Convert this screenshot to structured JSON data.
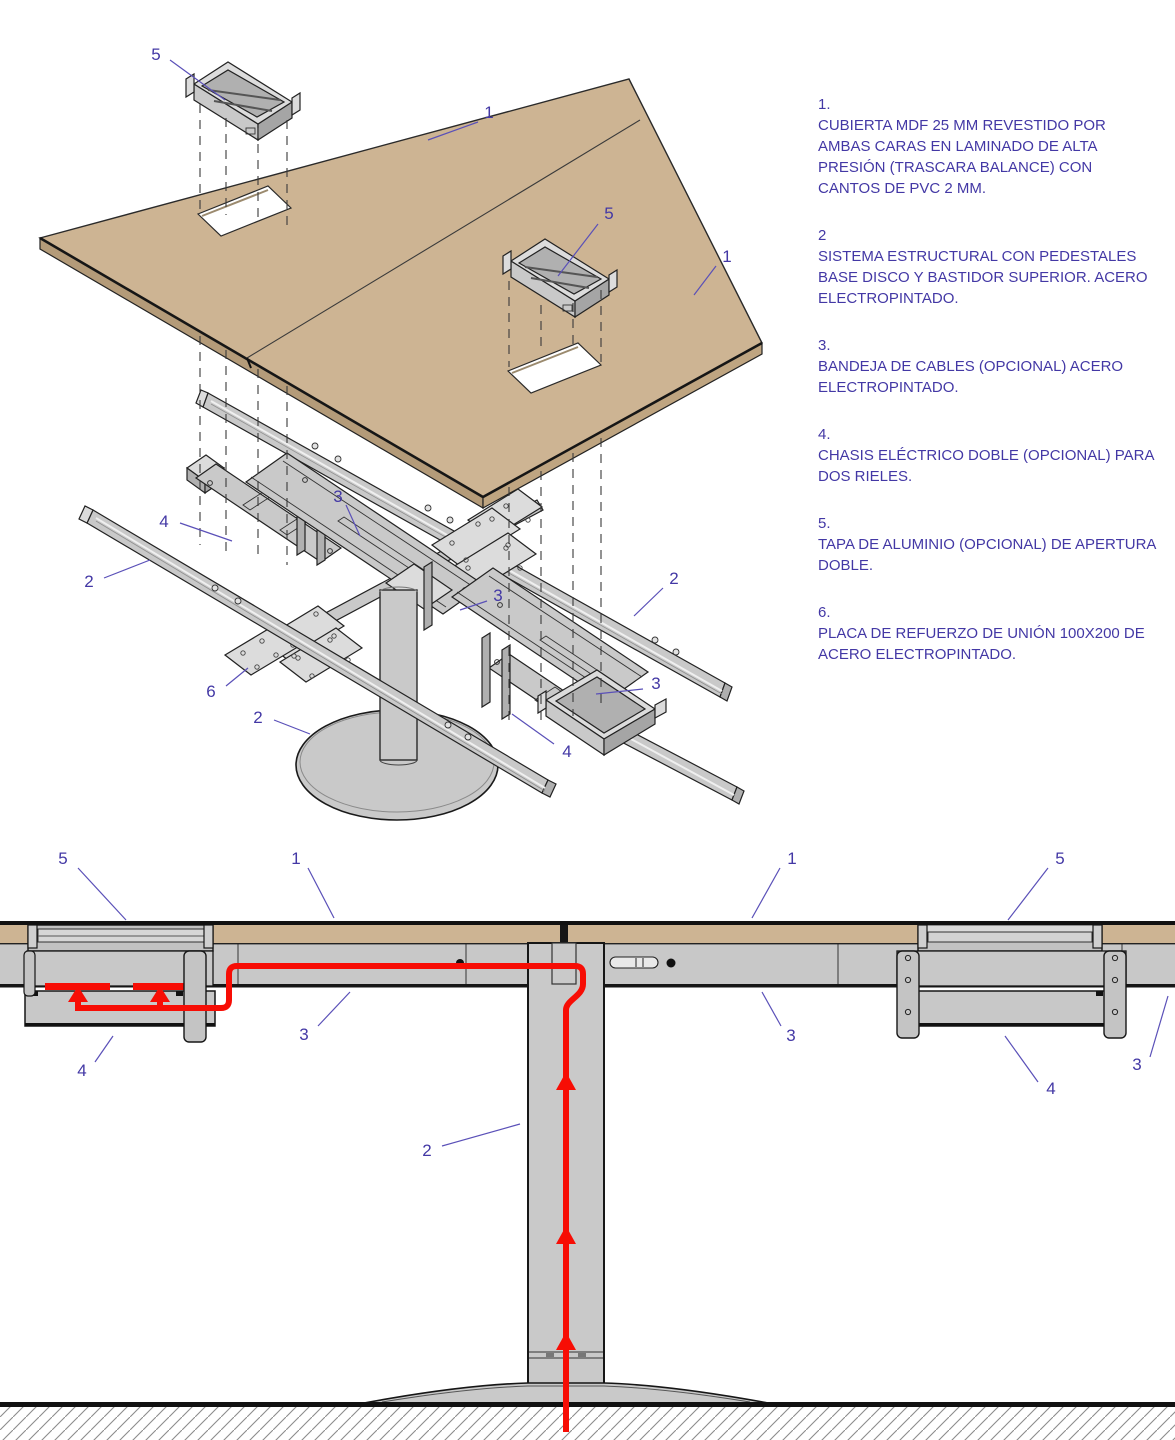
{
  "document": {
    "type": "furniture-technical-drawing",
    "language": "es",
    "views": [
      "exploded-isometric",
      "front-section-elevation"
    ]
  },
  "colors": {
    "tabletop_tan": "#cdb493",
    "tabletop_edge": "#b89b77",
    "metal_gray": "#c9c9c9",
    "cable_red": "#f70d05",
    "annotation_purple": "#4338a5",
    "leader_purple": "#5a50b8",
    "outline_black": "#222222"
  },
  "legend": {
    "items": [
      {
        "num": "1.",
        "text": "CUBIERTA MDF 25 MM REVESTIDO POR AMBAS CARAS EN LAMINADO DE ALTA PRESIÓN (TRASCARA BALANCE) CON CANTOS DE PVC 2 MM."
      },
      {
        "num": "2",
        "text": "SISTEMA ESTRUCTURAL CON PEDESTALES BASE DISCO Y BASTIDOR SUPERIOR. ACERO ELECTROPINTADO."
      },
      {
        "num": "3.",
        "text": "BANDEJA DE CABLES (OPCIONAL) ACERO ELECTROPINTADO."
      },
      {
        "num": "4.",
        "text": "CHASIS ELÉCTRICO DOBLE (OPCIONAL) PARA DOS RIELES."
      },
      {
        "num": "5.",
        "text": "TAPA DE ALUMINIO (OPCIONAL) DE APERTURA DOBLE."
      },
      {
        "num": "6.",
        "text": "PLACA DE REFUERZO DE UNIÓN 100X200 DE ACERO ELECTROPINTADO."
      }
    ]
  },
  "exploded_view": {
    "callouts": [
      "5",
      "1",
      "5",
      "1",
      "3",
      "4",
      "2",
      "3",
      "2",
      "6",
      "2",
      "3",
      "4"
    ]
  },
  "elevation_view": {
    "callouts": [
      "5",
      "1",
      "1",
      "5",
      "3",
      "4",
      "3",
      "2",
      "4",
      "3"
    ]
  }
}
